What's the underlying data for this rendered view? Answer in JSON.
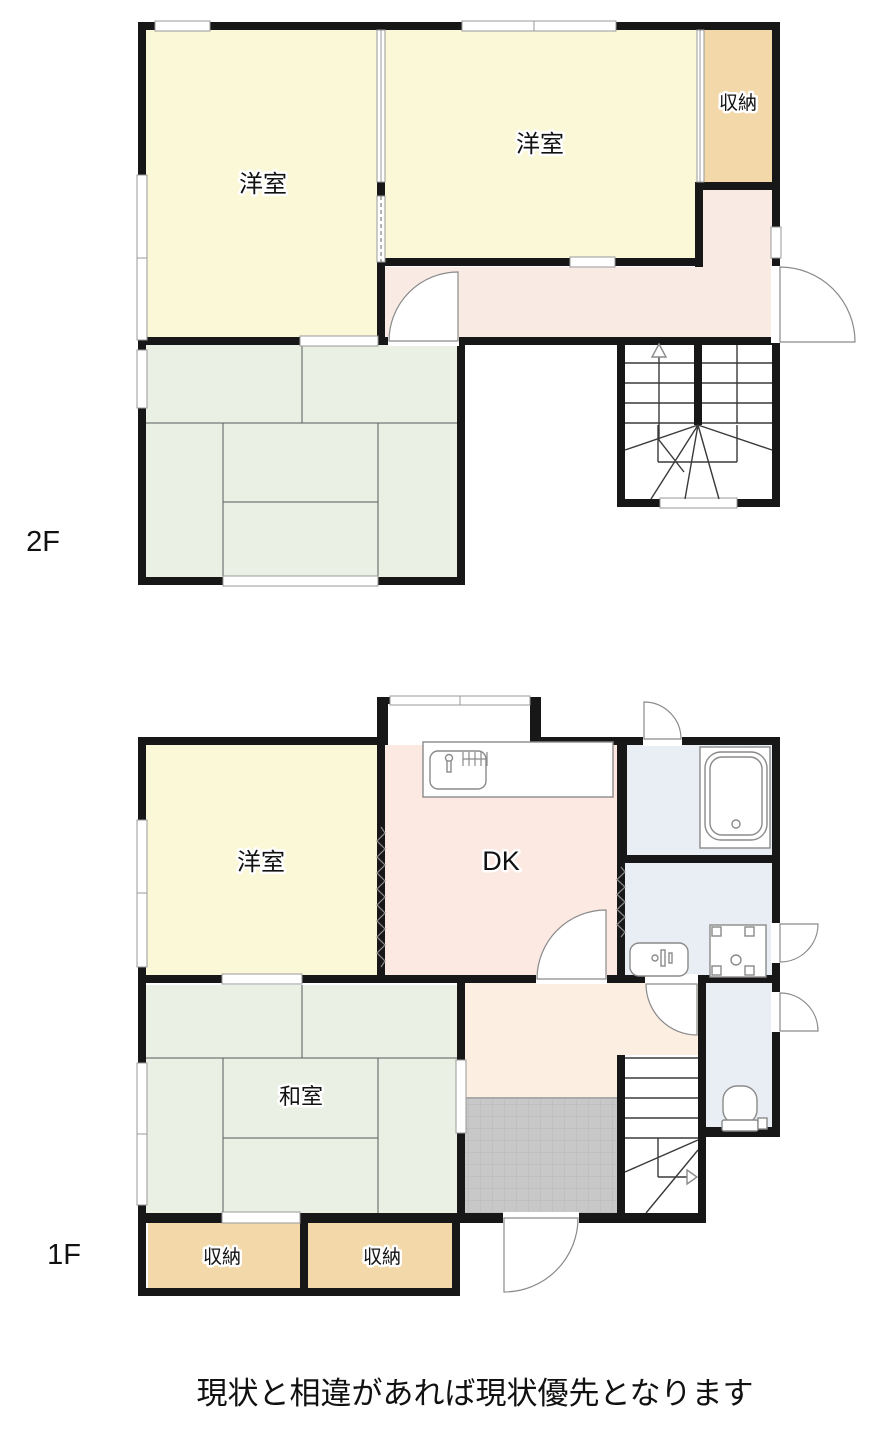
{
  "caption": "現状と相違があれば現状優先となります",
  "f2": {
    "label": "2F",
    "room_west_left": "洋室",
    "room_west_right": "洋室",
    "storage": "収納"
  },
  "f1": {
    "label": "1F",
    "western_room": "洋室",
    "dining_kitchen": "DK",
    "japanese_room": "和室",
    "storage_left": "収納",
    "storage_right": "収納"
  },
  "colors": {
    "wall_black": "#171717",
    "western_room_yellow": "#fbf8d8",
    "tatami_green": "#eaf0e4",
    "storage_tan": "#f3d9a9",
    "hall_2f_pink": "#f9ebe4",
    "dk_pink": "#fbe9e2",
    "hall_1f_cream": "#fcefe2",
    "wet_area_blue": "#e9eef4",
    "genkan_tile_gray": "#c8c8c8"
  }
}
